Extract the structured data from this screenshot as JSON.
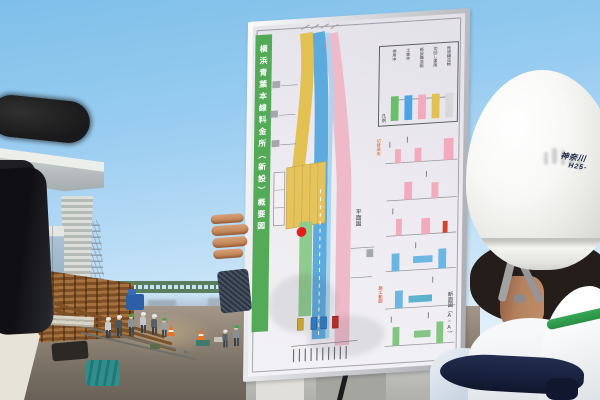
{
  "scene": {
    "setting": "outdoor construction-site press briefing, blue sky",
    "sky_color": "#8ec6ec",
    "ground_color": "#8d8274"
  },
  "poster": {
    "title_vertical": "横浜青葉本線料金所（新設）概要図",
    "plan_view_label": "平面図",
    "section_view_label": "断面図（A−A）",
    "marker_color": "#e51c1c",
    "legend": {
      "title": "凡例",
      "items": [
        {
          "label": "供用中",
          "color": "#6abf6a"
        },
        {
          "label": "工事中",
          "color": "#4da3e8"
        },
        {
          "label": "新設構造物",
          "color": "#f2aabc"
        },
        {
          "label": "切回し運用",
          "color": "#e2c052"
        },
        {
          "label": "既設構造物",
          "color": "#d8d8da"
        }
      ]
    },
    "annotations": {
      "orange": "切替運用",
      "red": "施工範囲"
    },
    "road_colors": {
      "yellow": "#e2c052",
      "blue": "#5caade",
      "light_blue": "#a9d6ee",
      "pink": "#eeb9c9",
      "green": "#8ecb8e"
    }
  },
  "foreground": {
    "helmet_text_line1": "神奈川",
    "helmet_text_line2": "H25-"
  }
}
